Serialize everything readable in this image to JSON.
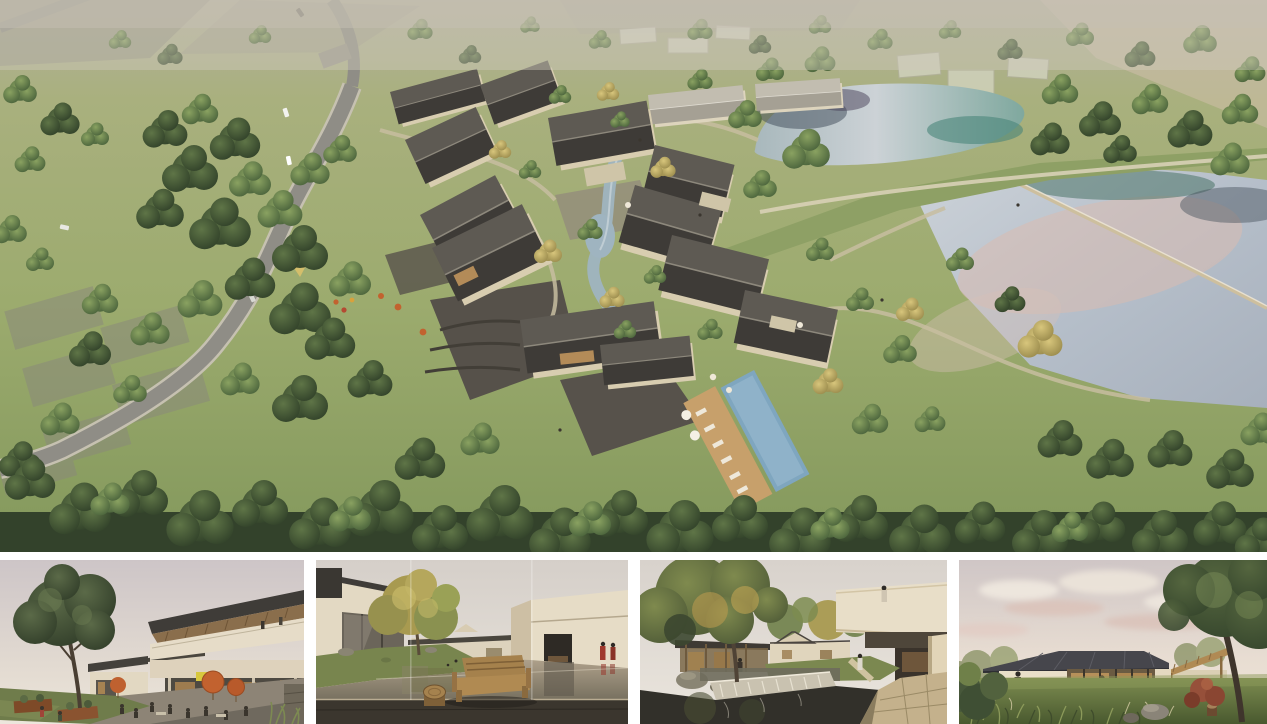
{
  "document": {
    "type": "architectural-rendering-collage",
    "background_color": "#ffffff",
    "panel_count": 5
  },
  "panels": {
    "aerial": {
      "name": "aerial-masterplan-rendering",
      "description": "Bird's-eye rendering of a courtyard-house resort village: dark gabled roofs around a winding stream, lap pool and stone courtyards, a curving access road with cars through meadows and dense tree belts, an upper pond and a large lower lake with pink sky reflections separated by a grass dam footpath, hazy existing fields at the horizon"
    },
    "thumbnails": [
      {
        "name": "retail-lane-view",
        "description": "Street-level rendering of the village retail lane: two-storey building with tilted timber-lined roof and balcony, cafe terrace with orange umbrellas, lawn and corten planters under a large tree"
      },
      {
        "name": "water-courtyard-view",
        "description": "Courtyard rendering with a shallow reflecting pond between cream guesthouses, a golden tree, wooden bench and log stool on a dark timber deck, two visitors in red coats"
      },
      {
        "name": "garden-weir-view",
        "description": "Garden courtyard rendering with a large canopy tree, glass pavilion, stone weir waterfall spilling into a dark pond, and a cantilevered cream guest wing with a visitor on its roof terrace"
      },
      {
        "name": "lawn-pavilion-view",
        "description": "Dusk rendering of a single-storey glass pavilion with a dark hipped metal roof and warm lit interior, set in a wild-grass meadow with rocks, a red maple and a large tree under a pink cloudy sky"
      }
    ]
  },
  "palette": {
    "canvas_white": "#ffffff",
    "meadow_green": "#9cab6e",
    "tree_dark_green": "#31412a",
    "tree_mid_green": "#5e7546",
    "tree_yellow": "#c9b96a",
    "roof_dark": "#3e3b37",
    "roof_light": "#b5b0a4",
    "wall_beige": "#ddd3ba",
    "road_grey": "#8f8d86",
    "stone_grey": "#55514a",
    "pond_teal": "#4c8a7e",
    "water_silver": "#c6ccd3",
    "water_pink_reflection": "#d9bfb4",
    "pool_blue": "#7fa6bf",
    "timber": "#9a7a50",
    "umbrella_orange": "#c2622f",
    "sky_pink": "#e3cdc6",
    "interior_glow": "#c89a5e"
  }
}
